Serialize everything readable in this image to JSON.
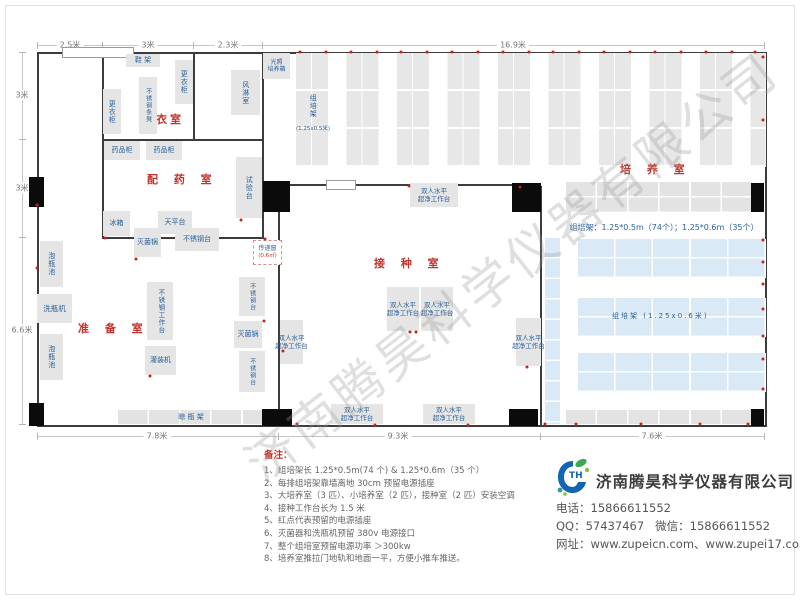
{
  "dims": {
    "top": [
      "2.5米",
      "3米",
      "2.3米",
      "16.9米"
    ],
    "left": [
      "3米",
      "3米",
      "6.6米"
    ],
    "bottom": [
      "7.8米",
      "9.3米",
      "7.6米"
    ]
  },
  "rooms": {
    "changing": "更衣室",
    "dispensing": "配 药 室",
    "prep": "准 备 室",
    "inoculation": "接 种 室",
    "culture": "培 养 室"
  },
  "equipment": {
    "shoe_rack": "鞋 架",
    "locker": "更衣柜",
    "steel_bench": "不锈钢条凳",
    "air_shower": "风淋室",
    "light_incubator_l1": "光照",
    "light_incubator_l2": "培养箱",
    "tc_rack": "组培架",
    "tc_rack_size_small": "(1.25x0.5米)",
    "tc_rack_size_large": "(1.25x0.6米)",
    "medicine_cabinet": "药品柜",
    "fridge": "冰箱",
    "balance_table": "天平台",
    "test_bench": "试验台",
    "sterilizer": "灭菌锅",
    "steel_table": "不锈钢台",
    "pass_window": "传递窗",
    "pass_window_size": "(0.6㎡)",
    "steel_worktable": "不锈钢工作台",
    "filling_machine": "灌装机",
    "soak_pool": "泡瓶池",
    "bottle_washer": "洗瓶机",
    "drying_rack": "晾  瓶  架",
    "clean_bench_l1": "双人水平",
    "clean_bench_l2": "超净工作台"
  },
  "annotations": {
    "rack_spec": "组培架：1.25*0.5m（74个）；1.25*0.6m（35个）"
  },
  "notes": {
    "title": "备注：",
    "items": [
      "1、组培架长 1.25*0.5m(74 个) & 1.25*0.6m（35 个）",
      "2、每排组培架靠墙离地 30cm 预留电源插座",
      "3、大培养室（3 匹）、小培养室（2 匹），接种室（2 匹）安装空调",
      "4、接种工作台长为 1.5 米",
      "5、红点代表预留的电源插座",
      "6、灭菌器和洗瓶机预留 380v 电源接口",
      "7、整个组培室预留电源功率 ＞300kw",
      "8、培养室推拉门地轨和地面一平，方便小推车推送。"
    ]
  },
  "company": {
    "logo_text": "TH",
    "name": "济南腾昊科学仪器有限公司",
    "phone_label": "电话：",
    "phone": "15866611552",
    "qq_label": "QQ：",
    "qq": "57437467",
    "wechat_label": "微信：",
    "wechat": "15866611552",
    "web_label": "网址：",
    "websites": "www.zupeicn.com、www.zupei17.com"
  },
  "watermark": {
    "text": "济南腾昊科学仪器有限公司"
  },
  "colors": {
    "room_label_red": "#c2342b",
    "equipment_text_blue": "#2a6099",
    "rack_blue": "#d9eaf6",
    "wall_dark": "#3c3c3c",
    "outlet_red": "#cc2020"
  },
  "outlets": [
    [
      300,
      52
    ],
    [
      326,
      52
    ],
    [
      351,
      52
    ],
    [
      377,
      52
    ],
    [
      401,
      52
    ],
    [
      427,
      52
    ],
    [
      452,
      52
    ],
    [
      478,
      52
    ],
    [
      503,
      52
    ],
    [
      529,
      52
    ],
    [
      553,
      52
    ],
    [
      579,
      52
    ],
    [
      604,
      52
    ],
    [
      630,
      52
    ],
    [
      655,
      52
    ],
    [
      681,
      52
    ],
    [
      706,
      52
    ],
    [
      732,
      52
    ],
    [
      755,
      52
    ],
    [
      763,
      57
    ],
    [
      763,
      120
    ],
    [
      763,
      240
    ],
    [
      763,
      262
    ],
    [
      763,
      284
    ],
    [
      763,
      309
    ],
    [
      763,
      336
    ],
    [
      763,
      359
    ],
    [
      763,
      389
    ],
    [
      37,
      205
    ],
    [
      37,
      268
    ],
    [
      409,
      186
    ],
    [
      520,
      187
    ],
    [
      297,
      424
    ],
    [
      375,
      425
    ],
    [
      468,
      425
    ],
    [
      545,
      424
    ],
    [
      576,
      424
    ],
    [
      641,
      424
    ],
    [
      700,
      424
    ],
    [
      748,
      424
    ],
    [
      265,
      239
    ],
    [
      150,
      376
    ],
    [
      264,
      321
    ],
    [
      283,
      351
    ],
    [
      527,
      367
    ],
    [
      410,
      332
    ],
    [
      416,
      332
    ],
    [
      136,
      259
    ],
    [
      241,
      220
    ],
    [
      105,
      238
    ]
  ]
}
